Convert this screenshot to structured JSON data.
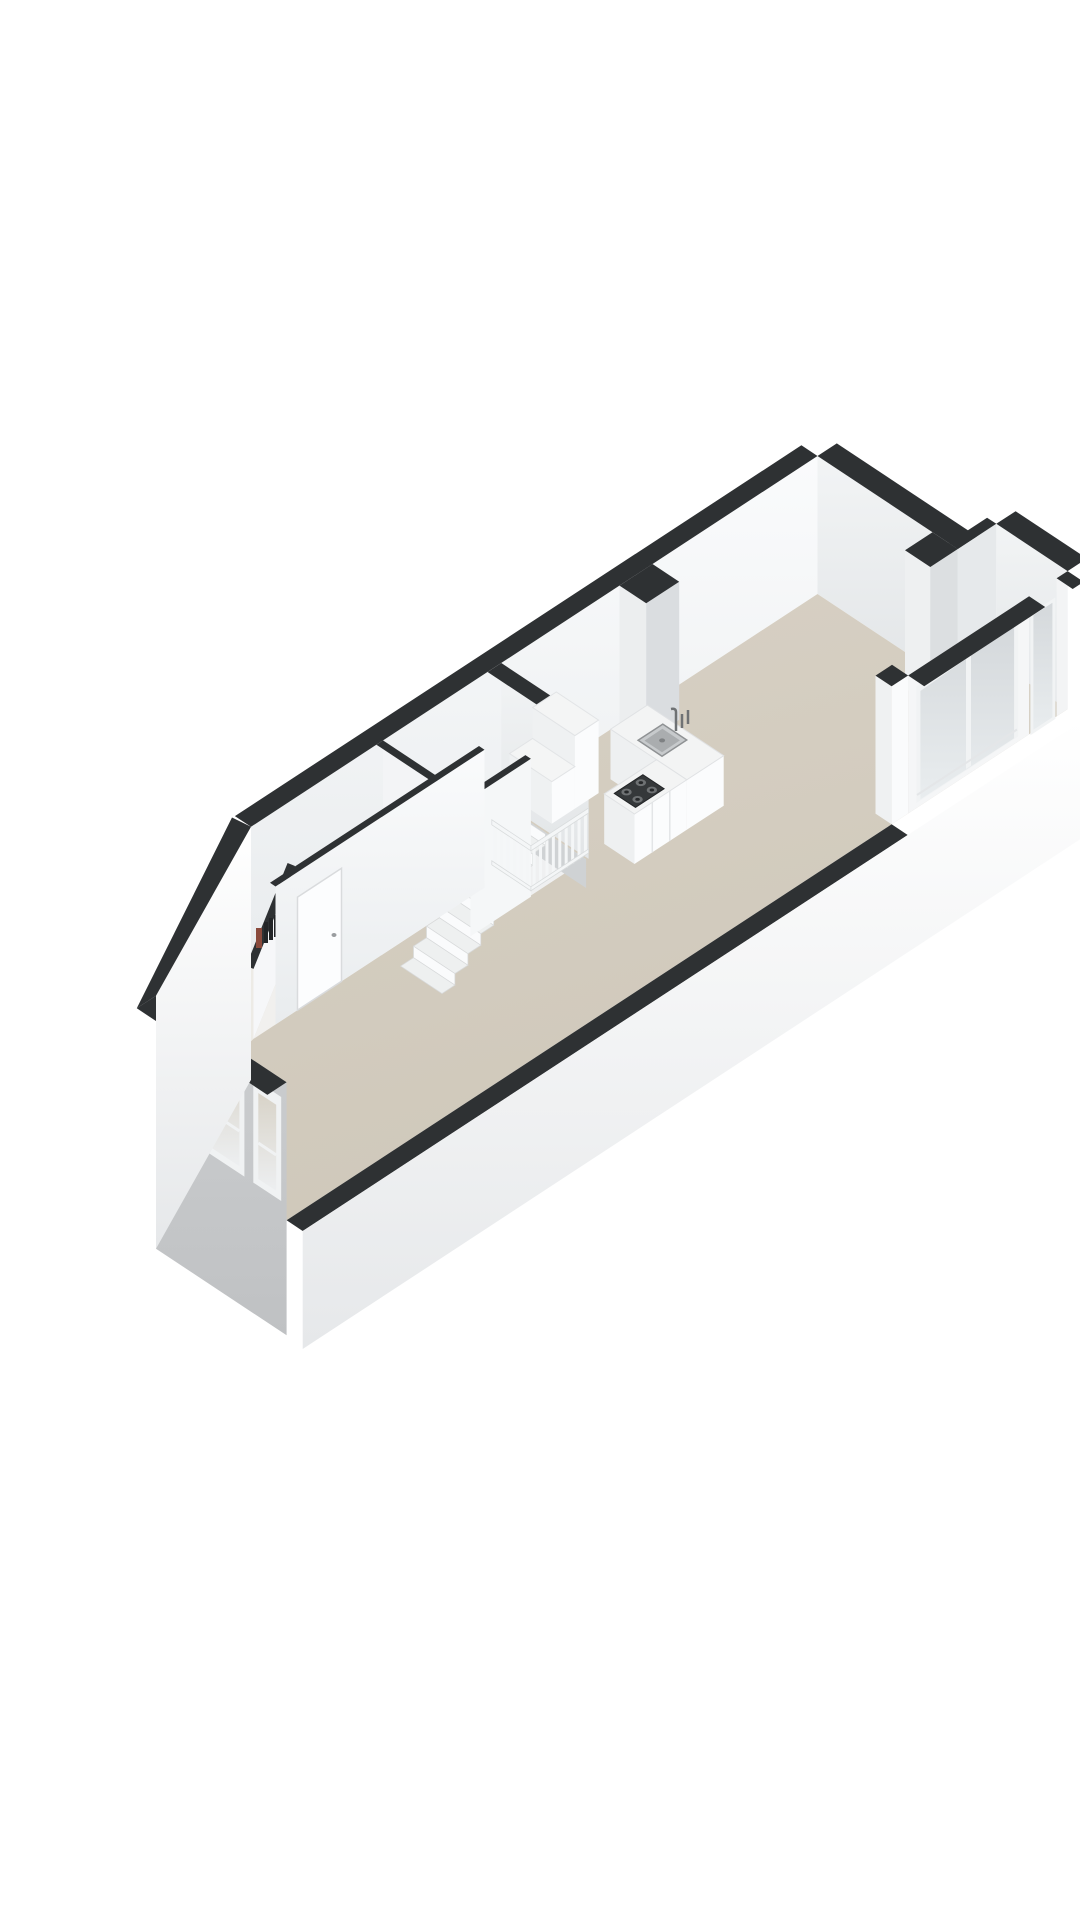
{
  "meta": {
    "kind": "3d-floor-plan-render",
    "view": "isometric",
    "visible_text": ""
  },
  "palette": {
    "background": "#ffffff",
    "wallTop": "#2e3133",
    "wallFace": "#f7f8fa",
    "wallFaceShaded": "#e9ebed",
    "innerGray": "#cfd2d4",
    "floor": "#d5cec1",
    "hallFloor": "#edebe6",
    "toiletFloor": "#f1f0ee",
    "holeFill": "#eff0f1",
    "exteriorBand": "#fbfcfc",
    "facade": "#c8cacc",
    "frame": "#f1f3f4",
    "glass": "#dde1e4",
    "counterTop": "#f3f4f4",
    "counterFace": "#fbfcfd",
    "counterSide": "#eef0f1",
    "stove": "#35383a",
    "burner": "#6e7173",
    "sinkBasin": "#aaadaf",
    "steel": "#8f9294",
    "stairTread": "#eef0f0",
    "stairRiser": "#fafbfc",
    "railing": "#f4f6f7",
    "bookRed": "#8a4a3c",
    "bookDark": "#232527"
  },
  "plan": {
    "fixtures": [
      {
        "name": "front-door"
      },
      {
        "name": "facade-window-1"
      },
      {
        "name": "facade-window-2"
      },
      {
        "name": "interior-door"
      },
      {
        "name": "staircase"
      },
      {
        "name": "balustrade"
      },
      {
        "name": "step-cupboard"
      },
      {
        "name": "kitchen-island"
      },
      {
        "name": "sink"
      },
      {
        "name": "faucet"
      },
      {
        "name": "gas-hob"
      },
      {
        "name": "chimney-column"
      },
      {
        "name": "duct-column"
      },
      {
        "name": "sliding-glass-door"
      },
      {
        "name": "balcony-niche"
      },
      {
        "name": "books-decor"
      }
    ]
  }
}
